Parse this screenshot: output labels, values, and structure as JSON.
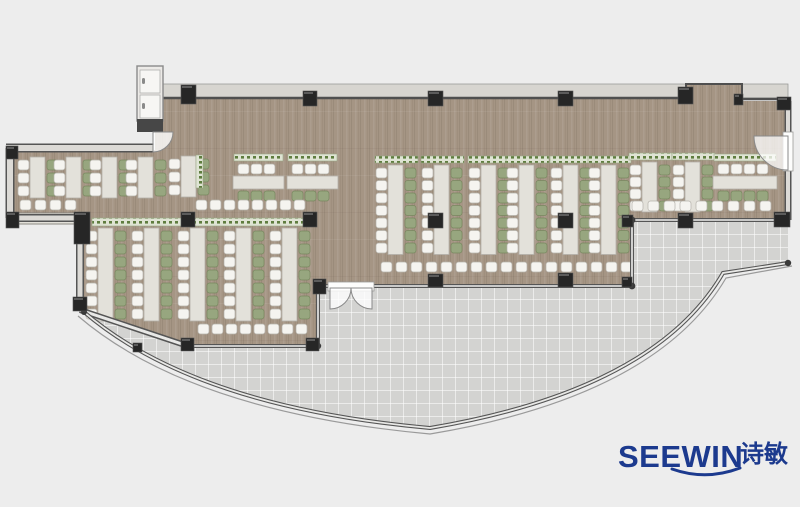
{
  "title": "SEEWIN office canteen floor plan",
  "logo": {
    "brand": "SEEWIN",
    "chinese": "诗敏",
    "color": "#1c3a8e"
  },
  "palette": {
    "background": "#ededed",
    "wood_floor": "#a59584",
    "terrace": "#d3d3d1",
    "terrace_line": "#e0e0de",
    "wall_dark": "#4f4f4f",
    "wall_light": "#dcdad6",
    "glass_core": "#efefed",
    "window_band": "#d7d5d0",
    "column": "#262626",
    "desk": "#e3e1da",
    "desk_edge": "#b3b0a9",
    "chair_white": "#f5f4f0",
    "chair_white_edge": "#b5b2ab",
    "chair_green": "#97a67f",
    "chair_green_edge": "#78875f",
    "planter_base": "#dfe4d4",
    "planter_green": "#5f7d3f",
    "door_fill": "#fdfdfc",
    "door_edge": "#8a8a8a"
  },
  "furniture": {
    "vertical_runs": [
      {
        "x": 30,
        "y": 157,
        "pairs": 3,
        "dy": 13,
        "planter": false
      },
      {
        "x": 66,
        "y": 157,
        "pairs": 3,
        "dy": 13,
        "planter": false
      },
      {
        "x": 102,
        "y": 157,
        "pairs": 3,
        "dy": 13,
        "planter": false
      },
      {
        "x": 138,
        "y": 157,
        "pairs": 3,
        "dy": 13,
        "planter": false
      },
      {
        "x": 181,
        "y": 156,
        "pairs": 3,
        "dy": 13,
        "planter": false
      },
      {
        "x": 98,
        "y": 228,
        "pairs": 7,
        "dy": 13,
        "planter": false
      },
      {
        "x": 144,
        "y": 228,
        "pairs": 7,
        "dy": 13,
        "planter": false
      },
      {
        "x": 190,
        "y": 228,
        "pairs": 7,
        "dy": 13,
        "planter": false
      },
      {
        "x": 236,
        "y": 228,
        "pairs": 7,
        "dy": 13,
        "planter": false
      },
      {
        "x": 282,
        "y": 228,
        "pairs": 7,
        "dy": 13,
        "planter": false
      },
      {
        "x": 388,
        "y": 165,
        "pairs": 7,
        "dy": 12.5,
        "planter": true
      },
      {
        "x": 434,
        "y": 165,
        "pairs": 7,
        "dy": 12.5,
        "planter": true
      },
      {
        "x": 481,
        "y": 165,
        "pairs": 7,
        "dy": 12.5,
        "planter": true
      },
      {
        "x": 519,
        "y": 165,
        "pairs": 7,
        "dy": 12.5,
        "planter": true
      },
      {
        "x": 563,
        "y": 165,
        "pairs": 7,
        "dy": 12.5,
        "planter": true
      },
      {
        "x": 601,
        "y": 165,
        "pairs": 7,
        "dy": 12.5,
        "planter": true
      },
      {
        "x": 642,
        "y": 162,
        "pairs": 4,
        "dy": 12,
        "planter": true
      },
      {
        "x": 685,
        "y": 162,
        "pairs": 4,
        "dy": 12,
        "planter": true
      }
    ],
    "horizontal_clusters": [
      {
        "x": 234,
        "y": 154,
        "chairs": 3
      },
      {
        "x": 288,
        "y": 154,
        "chairs": 3
      },
      {
        "x": 714,
        "y": 154,
        "chairs": 4
      }
    ],
    "chair_rows": [
      {
        "x": 196,
        "y": 200,
        "n": 8,
        "dx": 14
      },
      {
        "x": 20,
        "y": 200,
        "n": 4,
        "dx": 15
      },
      {
        "x": 381,
        "y": 262,
        "n": 17,
        "dx": 15
      },
      {
        "x": 632,
        "y": 201,
        "n": 9,
        "dx": 16
      },
      {
        "x": 198,
        "y": 324,
        "n": 8,
        "dx": 14
      }
    ],
    "planter_bands": [
      {
        "x": 92,
        "y": 218,
        "w": 216,
        "h": 8
      },
      {
        "x": 196,
        "y": 155,
        "w": 7,
        "h": 33
      }
    ],
    "counters": [
      {
        "x": 14,
        "y": 213,
        "w": 63,
        "h": 11
      }
    ],
    "columns": [
      [
        181,
        85,
        15,
        19
      ],
      [
        303,
        91,
        14,
        15
      ],
      [
        428,
        91,
        15,
        15
      ],
      [
        558,
        91,
        15,
        15
      ],
      [
        678,
        87,
        15,
        17
      ],
      [
        734,
        94,
        9,
        11
      ],
      [
        777,
        97,
        14,
        13
      ],
      [
        74,
        212,
        16,
        32
      ],
      [
        181,
        212,
        14,
        15
      ],
      [
        303,
        212,
        14,
        15
      ],
      [
        428,
        213,
        15,
        15
      ],
      [
        558,
        213,
        15,
        15
      ],
      [
        622,
        215,
        11,
        12
      ],
      [
        678,
        213,
        15,
        15
      ],
      [
        774,
        212,
        16,
        15
      ],
      [
        428,
        274,
        15,
        13
      ],
      [
        558,
        273,
        15,
        14
      ],
      [
        622,
        277,
        10,
        10
      ],
      [
        313,
        279,
        13,
        15
      ],
      [
        181,
        338,
        13,
        13
      ],
      [
        306,
        338,
        13,
        13
      ],
      [
        133,
        343,
        9,
        9
      ],
      [
        6,
        146,
        12,
        13
      ],
      [
        6,
        212,
        13,
        16
      ],
      [
        73,
        297,
        14,
        14
      ]
    ]
  }
}
